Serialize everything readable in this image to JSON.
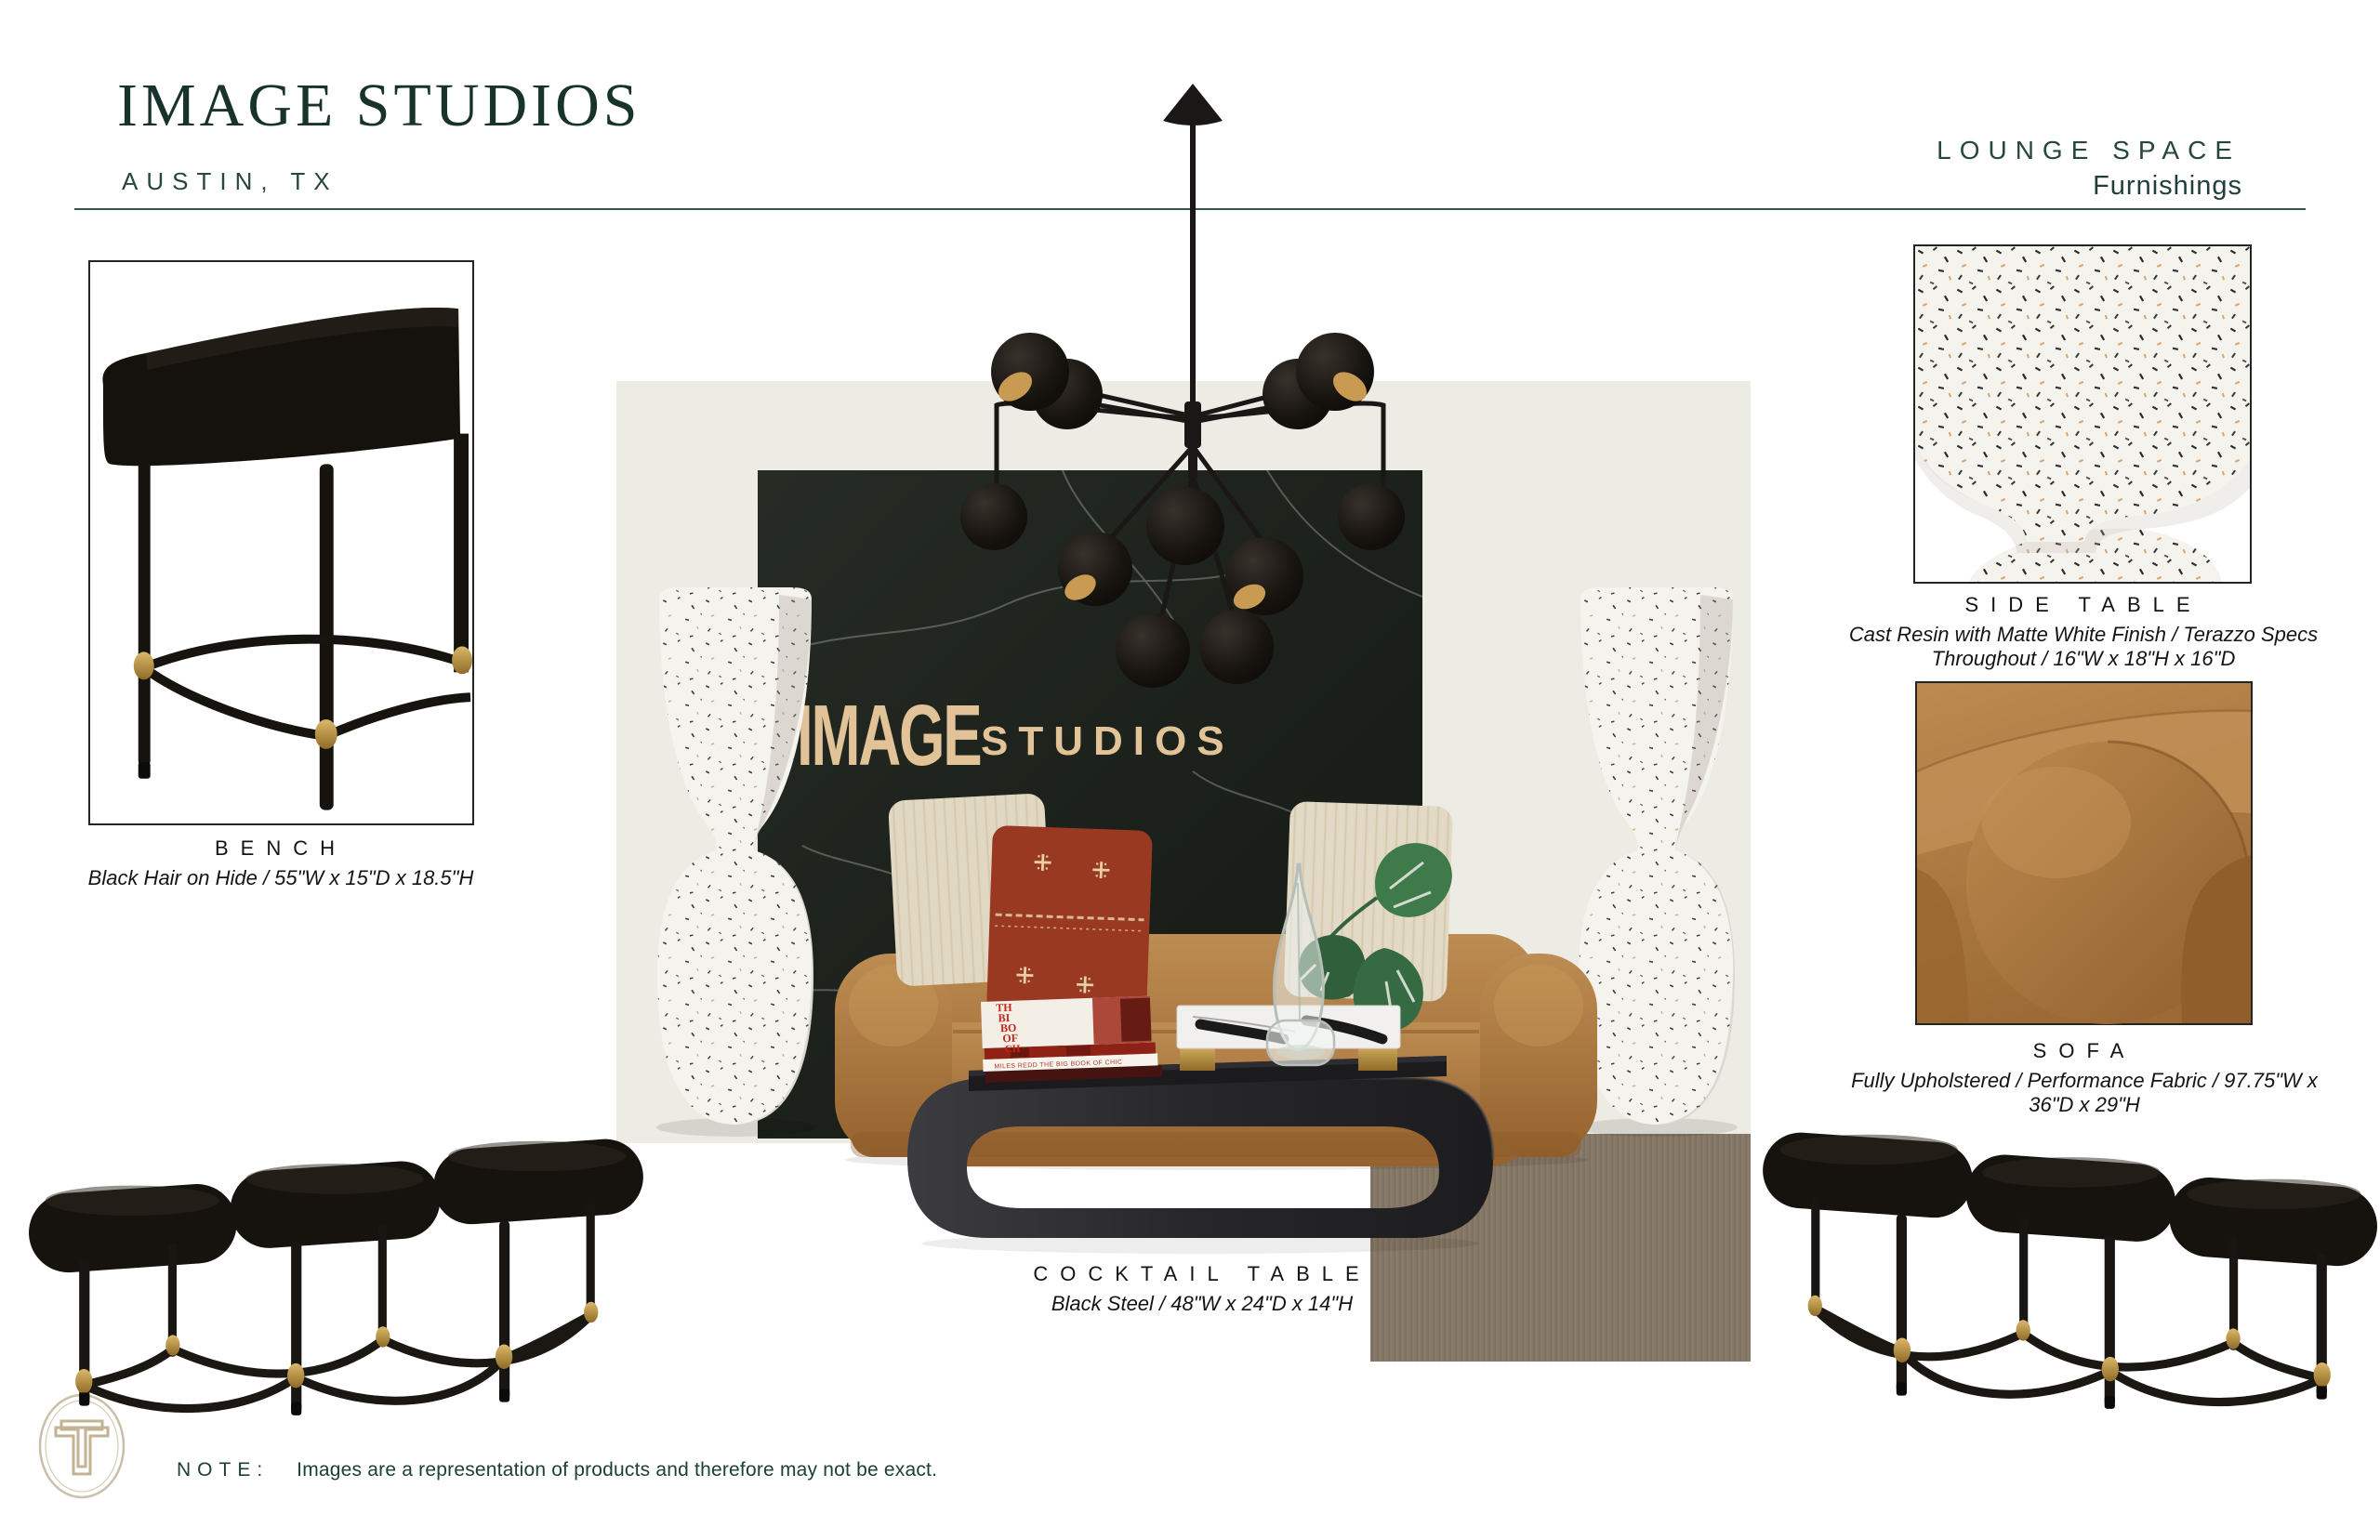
{
  "header": {
    "title": "IMAGE STUDIOS",
    "location": "AUSTIN, TX",
    "section": "LOUNGE SPACE",
    "section_subtitle": "Furnishings"
  },
  "products": {
    "bench": {
      "label": "BENCH",
      "spec": "Black Hair on Hide / 55\"W x 15\"D x 18.5\"H"
    },
    "side_table": {
      "label": "SIDE TABLE",
      "spec_line_1": "Cast Resin with Matte White Finish / Terazzo Specs",
      "spec_line_2": "Throughout / 16\"W x 18\"H x 16\"D"
    },
    "sofa": {
      "label": "SOFA",
      "spec_line_1": "Fully Upholstered / Performance Fabric / 97.75\"W x",
      "spec_line_2": "36\"D x 29\"H"
    },
    "cocktail_table": {
      "label": "COCKTAIL TABLE",
      "spec": "Black Steel / 48\"W x 24\"D x 14\"H"
    }
  },
  "scene": {
    "wall_logo_word_1": "IMAGE",
    "wall_logo_word_2": "STUDIOS",
    "book_cover_lines": [
      "TH",
      "BI",
      "BO",
      "OF",
      "CH"
    ],
    "book_spine_text": "MILES REDD THE BIG BOOK OF CHIC"
  },
  "footer": {
    "note_label": "NOTE:",
    "note_text": "Images are a representation of products and therefore may not be exact.",
    "monogram": "T"
  },
  "colors": {
    "brand_green": "#1d3a32",
    "brass": "#c09a4f",
    "cognac": "#b07a42",
    "marble_black": "#20251f",
    "terrazzo_white": "#f5f3ee",
    "rug_taupe": "#8b7d6b",
    "accent_red": "#a63d24",
    "wall_logo_cream": "#e2c398",
    "logo_beige": "#c3b394"
  }
}
